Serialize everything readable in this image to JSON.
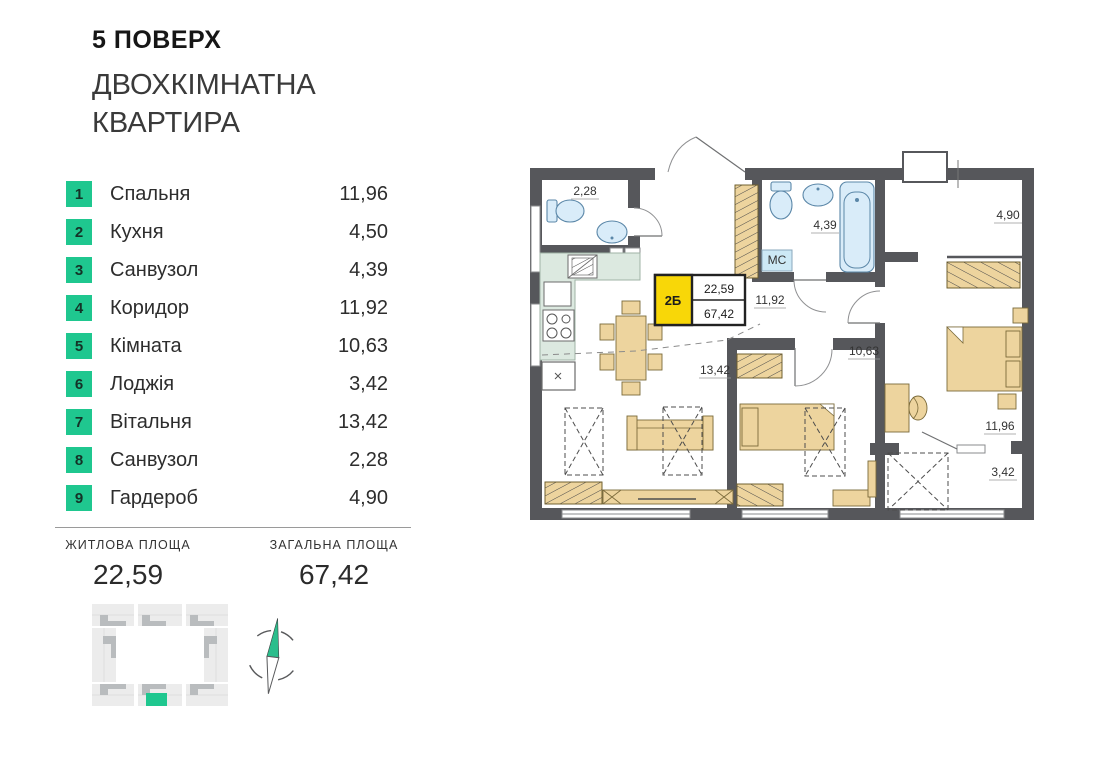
{
  "header": {
    "floor_label": "5 ПОВЕРХ",
    "apartment_type_line1": "ДВОХКІМНАТНА",
    "apartment_type_line2": "КВАРТИРА"
  },
  "room_list": [
    {
      "num": "1",
      "name": "Спальня",
      "area": "11,96"
    },
    {
      "num": "2",
      "name": "Кухня",
      "area": "4,50"
    },
    {
      "num": "3",
      "name": "Санвузол",
      "area": "4,39"
    },
    {
      "num": "4",
      "name": "Коридор",
      "area": "11,92"
    },
    {
      "num": "5",
      "name": "Кімната",
      "area": "10,63"
    },
    {
      "num": "6",
      "name": "Лоджія",
      "area": "3,42"
    },
    {
      "num": "7",
      "name": "Вітальня",
      "area": "13,42"
    },
    {
      "num": "8",
      "name": "Санвузол",
      "area": "2,28"
    },
    {
      "num": "9",
      "name": "Гардероб",
      "area": "4,90"
    }
  ],
  "summary": {
    "living": {
      "label": "ЖИТЛОВА ПЛОЩА",
      "value": "22,59"
    },
    "total": {
      "label": "ЗАГАЛЬНА ПЛОЩА",
      "value": "67,42"
    }
  },
  "floor_plan": {
    "unit_badge": {
      "unit": "2Б",
      "living_area": "22,59",
      "total_area": "67,42"
    },
    "room_labels": {
      "bathroom_small": "2,28",
      "bathroom": "4,39",
      "corridor": "11,92",
      "washing_machine": "МС",
      "wardrobe_room": "4,90",
      "living_room": "13,42",
      "room": "10,63",
      "bedroom": "11,96",
      "loggia": "3,42"
    }
  },
  "colors": {
    "accent_green": "#1FC78F",
    "badge_yellow": "#F8D708",
    "wall_gray": "#56575B",
    "furniture_tan": "#EDD49E",
    "fixture_blue": "#D9ECF9",
    "kitchen_mint": "#DCE9E0"
  }
}
